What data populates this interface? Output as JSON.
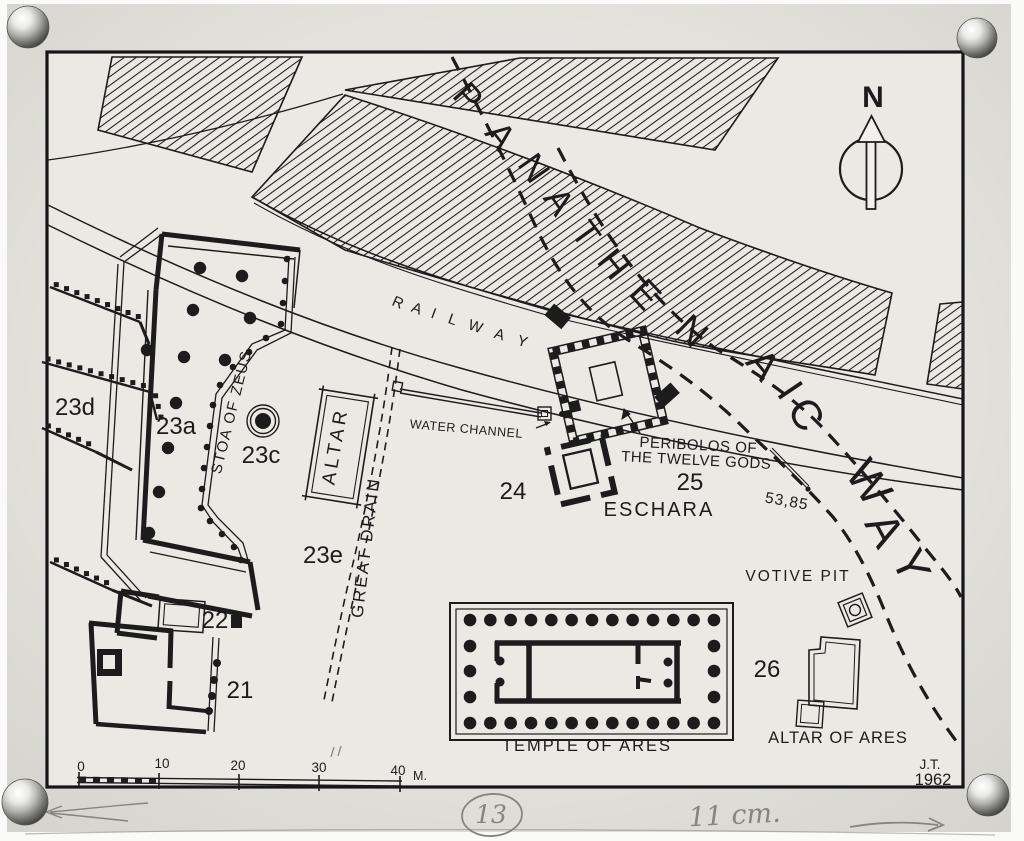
{
  "plan": {
    "road_name": "PANATHENAIC WAY",
    "railway_name": "RAILWAY",
    "compass": {
      "label": "N"
    },
    "credit": {
      "initials": "J.T.",
      "year": "1962"
    },
    "scale_bar": {
      "ticks": [
        "0",
        "10",
        "20",
        "30",
        "40"
      ],
      "unit": "M."
    },
    "way_letters": [
      {
        "ch": "P",
        "x": 459,
        "y": 105,
        "r": 48,
        "s": 36
      },
      {
        "ch": "A",
        "x": 491,
        "y": 143,
        "r": 52,
        "s": 36
      },
      {
        "ch": "N",
        "x": 524,
        "y": 175,
        "r": 55,
        "s": 36
      },
      {
        "ch": "A",
        "x": 549,
        "y": 208,
        "r": 56,
        "s": 36
      },
      {
        "ch": "T",
        "x": 576,
        "y": 241,
        "r": 54,
        "s": 36
      },
      {
        "ch": "H",
        "x": 604,
        "y": 272,
        "r": 51,
        "s": 37
      },
      {
        "ch": "E",
        "x": 636,
        "y": 303,
        "r": 47,
        "s": 38
      },
      {
        "ch": "N",
        "x": 683,
        "y": 340,
        "r": 44,
        "s": 38
      },
      {
        "ch": "A",
        "x": 753,
        "y": 373,
        "r": 50,
        "s": 40
      },
      {
        "ch": "I",
        "x": 779,
        "y": 398,
        "r": 56,
        "s": 40
      },
      {
        "ch": "C",
        "x": 794,
        "y": 422,
        "r": 58,
        "s": 42
      },
      {
        "ch": "W",
        "x": 856,
        "y": 491,
        "r": 56,
        "s": 46
      },
      {
        "ch": "A",
        "x": 871,
        "y": 537,
        "r": 62,
        "s": 46
      },
      {
        "ch": "Y",
        "x": 897,
        "y": 572,
        "r": 66,
        "s": 46
      }
    ],
    "railway_letters": [
      {
        "ch": "R",
        "x": 396,
        "y": 307,
        "r": 24,
        "s": 15
      },
      {
        "ch": "A",
        "x": 415,
        "y": 313,
        "r": 22,
        "s": 15
      },
      {
        "ch": "I",
        "x": 432,
        "y": 318,
        "r": 21,
        "s": 15
      },
      {
        "ch": "L",
        "x": 451,
        "y": 324,
        "r": 20,
        "s": 15
      },
      {
        "ch": "W",
        "x": 474,
        "y": 331,
        "r": 19,
        "s": 15
      },
      {
        "ch": "A",
        "x": 498,
        "y": 339,
        "r": 18,
        "s": 15
      },
      {
        "ch": "Y",
        "x": 521,
        "y": 346,
        "r": 17,
        "s": 15
      }
    ],
    "labels": [
      {
        "id": "stoa-of-zeus",
        "text": "STOA OF ZEUS",
        "x": 236,
        "y": 413,
        "rot": -76,
        "size": 15,
        "ls": 1.5
      },
      {
        "id": "altar",
        "text": "ALTAR",
        "x": 341,
        "y": 447,
        "rot": -80,
        "size": 19,
        "ls": 4
      },
      {
        "id": "great-drain",
        "text": "GREAT DRAIN",
        "x": 371,
        "y": 548,
        "rot": -83,
        "size": 17,
        "ls": 2.5
      },
      {
        "id": "water-channel",
        "text": "WATER CHANNEL",
        "x": 466,
        "y": 433,
        "rot": 5,
        "size": 12.5,
        "ls": 0.5
      },
      {
        "id": "peribolos-line1",
        "text": "PERIBOLOS OF",
        "x": 698,
        "y": 450,
        "rot": 3,
        "size": 15,
        "ls": 0.5
      },
      {
        "id": "peribolos-line2",
        "text": "THE TWELVE GODS",
        "x": 696,
        "y": 465,
        "rot": 3,
        "size": 15,
        "ls": 0.5
      },
      {
        "id": "eschara",
        "text": "ESCHARA",
        "x": 659,
        "y": 516,
        "rot": 0,
        "size": 20,
        "ls": 2
      },
      {
        "id": "elevation",
        "text": "53,85",
        "x": 786,
        "y": 506,
        "rot": 10,
        "size": 15.5,
        "ls": 1
      },
      {
        "id": "votive-pit",
        "text": "VOTIVE PIT",
        "x": 798,
        "y": 581,
        "rot": 0,
        "size": 15.5,
        "ls": 2
      },
      {
        "id": "temple-of-ares",
        "text": "TEMPLE OF ARES",
        "x": 587,
        "y": 751,
        "rot": 0,
        "size": 16.5,
        "ls": 2
      },
      {
        "id": "altar-of-ares",
        "text": "ALTAR OF ARES",
        "x": 838,
        "y": 743,
        "rot": 0,
        "size": 16.5,
        "ls": 1
      },
      {
        "id": "num-23d",
        "text": "23d",
        "x": 75,
        "y": 415,
        "rot": 0,
        "size": 24,
        "ls": 0
      },
      {
        "id": "num-23a",
        "text": "23a",
        "x": 176,
        "y": 434,
        "rot": 0,
        "size": 24,
        "ls": 0
      },
      {
        "id": "num-23c",
        "text": "23c",
        "x": 261,
        "y": 463,
        "rot": 0,
        "size": 24,
        "ls": 0
      },
      {
        "id": "num-23e",
        "text": "23e",
        "x": 323,
        "y": 563,
        "rot": 0,
        "size": 24,
        "ls": 0
      },
      {
        "id": "num-22",
        "text": "22",
        "x": 215,
        "y": 628,
        "rot": 0,
        "size": 24,
        "ls": 0
      },
      {
        "id": "num-21",
        "text": "21",
        "x": 240,
        "y": 698,
        "rot": 0,
        "size": 24,
        "ls": 0
      },
      {
        "id": "num-24",
        "text": "24",
        "x": 513,
        "y": 499,
        "rot": 0,
        "size": 24,
        "ls": 0
      },
      {
        "id": "num-25",
        "text": "25",
        "x": 690,
        "y": 490,
        "rot": 0,
        "size": 24,
        "ls": 0
      },
      {
        "id": "num-26",
        "text": "26",
        "x": 767,
        "y": 677,
        "rot": 0,
        "size": 24,
        "ls": 0
      },
      {
        "id": "credit-initials",
        "text": "J.T.",
        "x": 930,
        "y": 769,
        "rot": 0,
        "size": 13.5,
        "ls": 0
      },
      {
        "id": "credit-year",
        "text": "1962",
        "x": 933,
        "y": 785,
        "rot": 0,
        "size": 16.5,
        "ls": 0
      },
      {
        "id": "scale-0",
        "text": "0",
        "x": 81,
        "y": 771,
        "rot": 0,
        "size": 13.5,
        "ls": 0
      },
      {
        "id": "scale-10",
        "text": "10",
        "x": 162,
        "y": 768,
        "rot": 0,
        "size": 13.5,
        "ls": 0
      },
      {
        "id": "scale-20",
        "text": "20",
        "x": 238,
        "y": 770,
        "rot": 0,
        "size": 13.5,
        "ls": 0
      },
      {
        "id": "scale-30",
        "text": "30",
        "x": 319,
        "y": 772,
        "rot": 0,
        "size": 13.5,
        "ls": 0
      },
      {
        "id": "scale-40",
        "text": "40",
        "x": 398,
        "y": 775,
        "rot": 0,
        "size": 13.5,
        "ls": 0
      },
      {
        "id": "scale-unit",
        "text": "M.",
        "x": 420,
        "y": 780,
        "rot": 0,
        "size": 12.5,
        "ls": 0
      },
      {
        "id": "north-letter",
        "text": "N",
        "x": 873,
        "y": 107,
        "rot": 0,
        "size": 30,
        "ls": 0,
        "bold": true
      }
    ],
    "pencil_annotations": {
      "sheet_number": "13",
      "note": "11 cm."
    },
    "colors": {
      "ink": "#1c1c1c",
      "paper": "#e7e6e1",
      "pencil": "#85847e"
    }
  }
}
